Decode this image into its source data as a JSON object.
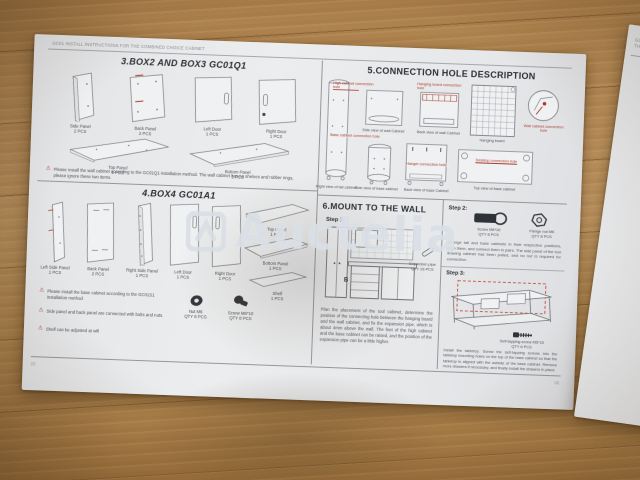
{
  "colors": {
    "annotation_red": "#ab3a2c",
    "paper": "#e9eaec",
    "wood": "#b98e57",
    "ink": "#45484e"
  },
  "watermark": {
    "text": "Auctelia"
  },
  "page": {
    "header": "GC01 INSTALL INSTRUCTIONS FOR THE COMBINED CHOICE CABINET",
    "page_number_left": "22",
    "page_number_right": "06",
    "section3": {
      "title": "3.BOX2 AND BOX3 GC01Q1",
      "parts": [
        {
          "name": "Side Panel",
          "qty": "2 PCS"
        },
        {
          "name": "Back Panel",
          "qty": "2 PCS"
        },
        {
          "name": "Left Door",
          "qty": "1 PCS"
        },
        {
          "name": "Right Door",
          "qty": "1 PCS"
        },
        {
          "name": "Top Panel",
          "qty": "1 PCS"
        },
        {
          "name": "Bottom Panel",
          "qty": "1 PCS"
        }
      ],
      "note": "Please install the wall cabinet according to the GC01Q1 installation method. The wall cabinet has no shelves and rubber rings, please ignore these two items."
    },
    "section4": {
      "title": "4.BOX4 GC01A1",
      "parts": [
        {
          "name": "Left Side Panel",
          "qty": "1 PCS"
        },
        {
          "name": "Back Panel",
          "qty": "2 PCS"
        },
        {
          "name": "Right Side Panel",
          "qty": "1 PCS"
        },
        {
          "name": "Left Door",
          "qty": "1 PCS"
        },
        {
          "name": "Right Door",
          "qty": "1 PCS"
        },
        {
          "name": "Top Panel",
          "qty": "1 PCS"
        },
        {
          "name": "Bottom Panel",
          "qty": "1 PCS"
        },
        {
          "name": "Shelf",
          "qty": "1 PCS"
        }
      ],
      "notes": [
        "Please install the base cabinet according to the GC01S1 installation method",
        "Side panel and back panel are connected with bolts and nuts.",
        "Shelf can be adjusted at will"
      ],
      "hardware": [
        {
          "name": "Nut M6",
          "qty": "QTY 8 PCS"
        },
        {
          "name": "Screw M6*10",
          "qty": "QTY 8 PCS"
        }
      ]
    },
    "section5": {
      "title": "5.CONNECTION HOLE DESCRIPTION",
      "labels": {
        "tall": "Right view of tall cabinet",
        "side_wall": "Side view of wall Cabinet",
        "back_wall": "Back view of wall Cabinet",
        "hanging_board": "Hanging board",
        "side_base": "Side view of base cabinet",
        "back_base": "Back view of base Cabinet",
        "top_base": "Top view of base cabinet"
      },
      "annotations": {
        "high_cabinet": "High cabinet connection hole",
        "hanging_board": "Hanging board connection hole",
        "wall_cabinet": "Wall cabinet connection hole",
        "base_cabinet": "Base cabinet connection hole",
        "hanger": "Hanger connection hole",
        "desktop": "Desktop connection hole"
      }
    },
    "section6": {
      "title": "6.MOUNT TO THE WALL",
      "step1_label": "Step 1:",
      "hardware": {
        "name": "Expansion pipe",
        "qty": "QTY 16 PCS"
      },
      "paragraph": "Plan the placement of the tool cabinet, determine the position of the connecting hole between the hanging board and the wall cabinet, and fix the expansion pipe, which is about 4mm above the wall. The feet of the high cabinet and the base cabinet can be raised, and the position of the expansion pipe can be a little higher."
    },
    "steps_panel": {
      "step2_label": "Step 2:",
      "step2_hardware": [
        {
          "name": "Screw M6*16",
          "qty": "QTY 8 PCS"
        },
        {
          "name": "Flange nut M6",
          "qty": "QTY 8 PCS"
        }
      ],
      "step2_paragraph": "Arrange tall and base cabinets in their respective positions, align them, and connect them in pairs. The side panel of the tool drawing cabinet has been pulled, and no nut is required for connection.",
      "step3_label": "Step 3:",
      "step3_hardware": {
        "name": "Self-tapping screw M5*15",
        "qty": "QTY 6 PCS"
      },
      "step3_paragraph": "Install the tabletop. Screw the self-tapping screws into the tabletop mounting holes on the top of the base cabinet so that the tabletop is aligned with the outside of the base cabinet. Remove more drawers if necessary, and finally install the drawers in place."
    }
  },
  "side_sheet": {
    "header": "GC01 INSTALL INSTRUCTIONS FOR THE COMBINED CHOICE CABINET"
  }
}
